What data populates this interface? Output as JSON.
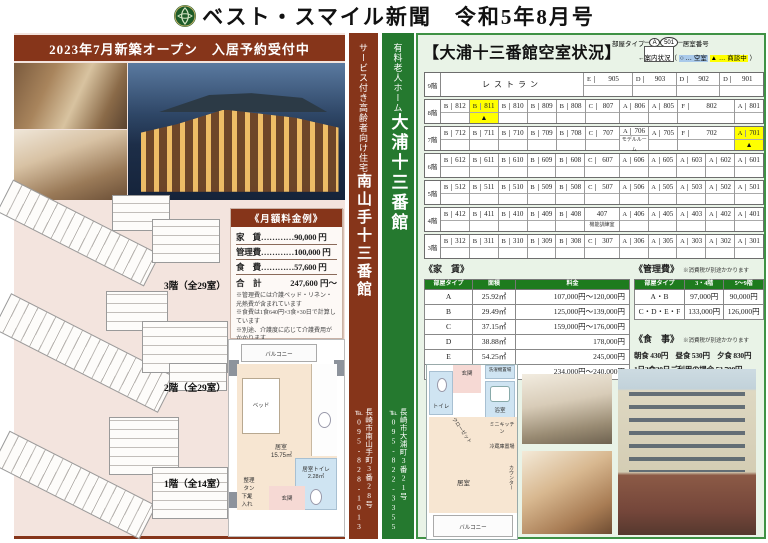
{
  "colors": {
    "maroon": "#86351a",
    "green": "#25792f",
    "table_green": "#1e7b1e",
    "highlight_yellow": "#ffff00",
    "highlight_blue": "#a9c9ea",
    "left_bg": "#f3e4de",
    "right_bg": "#e9f3e7"
  },
  "header": {
    "title": "ベスト・スマイル新聞　令和5年8月号",
    "logo": "camellia-emblem"
  },
  "left": {
    "banner": "2023年7月新築オープン　入居予約受付中",
    "floor_labels": [
      "3階（全29室）",
      "2階（全29室）",
      "1階（全14室）"
    ],
    "fee_box": {
      "title": "《月額料金例》",
      "lines": [
        "家　賃…………90,000 円",
        "管理費…………100,000 円",
        "食　費…………57,600 円"
      ],
      "total_label": "合　計",
      "total_value": "247,600 円～",
      "notes": [
        "※管理費には介護ベッド・リネン・光熱費が含まれています",
        "※食費は1食640円×3食×30日で計算しています",
        "※別途、介護度に応じて介護費用がかかります"
      ]
    },
    "room_plan": {
      "balcony": "バルコニー",
      "bed": "ベッド",
      "room": "居室",
      "room_size": "15.75㎡",
      "toilet": "居室トイレ",
      "toilet_size": "2.28㎡",
      "chest": "整理タンス",
      "shoe": "下足入れ",
      "entrance": "玄関"
    }
  },
  "strips": {
    "maroon": {
      "service": "サービス付き高齢者向け住宅",
      "name": "南山手十三番館",
      "address": "長崎市南山手町3番28号",
      "tel": "℡095-828-1013"
    },
    "green": {
      "service": "有料老人ホーム",
      "name": "大浦十三番館",
      "address": "長崎市大浦町3番21号",
      "tel": "℡095-822-3355"
    }
  },
  "right": {
    "title": "【大浦十三番館空室状況】",
    "legend": {
      "type_label": "部屋タイプ",
      "type_sample": "A",
      "no_sample": "501",
      "no_label": "居室番号",
      "status_prefix": "案内状況（",
      "vacant": "○ … 空室",
      "nego": "▲ … 商談中",
      "status_suffix": "）"
    },
    "grid": {
      "floors": [
        {
          "floor": "9階",
          "rooms": [
            {
              "label": "レストラン",
              "span": 5
            },
            {
              "type": "E",
              "no": "905",
              "span": 1.7
            },
            {
              "type": "D",
              "no": "903",
              "span": 1.5
            },
            {
              "type": "D",
              "no": "902",
              "span": 1.5
            },
            {
              "type": "D",
              "no": "901",
              "span": 1.5
            }
          ]
        },
        {
          "floor": "8階",
          "rooms": [
            {
              "type": "B",
              "no": "812"
            },
            {
              "type": "B",
              "no": "811",
              "status": "▲",
              "hl": true
            },
            {
              "type": "B",
              "no": "810"
            },
            {
              "type": "B",
              "no": "809"
            },
            {
              "type": "B",
              "no": "808"
            },
            {
              "type": "C",
              "no": "807",
              "span": 1.2
            },
            {
              "type": "A",
              "no": "806"
            },
            {
              "type": "A",
              "no": "805"
            },
            {
              "type": "F",
              "no": "802",
              "span": 2
            },
            {
              "type": "A",
              "no": "801"
            }
          ]
        },
        {
          "floor": "7階",
          "rooms": [
            {
              "type": "B",
              "no": "712"
            },
            {
              "type": "B",
              "no": "711"
            },
            {
              "type": "B",
              "no": "710"
            },
            {
              "type": "B",
              "no": "709"
            },
            {
              "type": "B",
              "no": "708"
            },
            {
              "type": "C",
              "no": "707",
              "span": 1.2
            },
            {
              "type": "A",
              "no": "706",
              "note": "モデルルーム"
            },
            {
              "type": "A",
              "no": "705"
            },
            {
              "type": "F",
              "no": "702",
              "span": 2
            },
            {
              "type": "A",
              "no": "701",
              "status": "▲",
              "hl": true
            }
          ]
        },
        {
          "floor": "6階",
          "rooms": [
            {
              "type": "B",
              "no": "612"
            },
            {
              "type": "B",
              "no": "611"
            },
            {
              "type": "B",
              "no": "610"
            },
            {
              "type": "B",
              "no": "609"
            },
            {
              "type": "B",
              "no": "608"
            },
            {
              "type": "C",
              "no": "607",
              "span": 1.2
            },
            {
              "type": "A",
              "no": "606"
            },
            {
              "type": "A",
              "no": "605"
            },
            {
              "type": "A",
              "no": "603"
            },
            {
              "type": "A",
              "no": "602"
            },
            {
              "type": "A",
              "no": "601"
            }
          ]
        },
        {
          "floor": "5階",
          "rooms": [
            {
              "type": "B",
              "no": "512"
            },
            {
              "type": "B",
              "no": "511"
            },
            {
              "type": "B",
              "no": "510"
            },
            {
              "type": "B",
              "no": "509"
            },
            {
              "type": "B",
              "no": "508"
            },
            {
              "type": "C",
              "no": "507",
              "span": 1.2
            },
            {
              "type": "A",
              "no": "506"
            },
            {
              "type": "A",
              "no": "505"
            },
            {
              "type": "A",
              "no": "503"
            },
            {
              "type": "A",
              "no": "502"
            },
            {
              "type": "A",
              "no": "501"
            }
          ]
        },
        {
          "floor": "4階",
          "rooms": [
            {
              "type": "B",
              "no": "412"
            },
            {
              "type": "B",
              "no": "411"
            },
            {
              "type": "B",
              "no": "410"
            },
            {
              "type": "B",
              "no": "409"
            },
            {
              "type": "B",
              "no": "408"
            },
            {
              "type": "",
              "no": "407",
              "span": 1.2,
              "note": "機能訓練室"
            },
            {
              "type": "A",
              "no": "406"
            },
            {
              "type": "A",
              "no": "405"
            },
            {
              "type": "A",
              "no": "403"
            },
            {
              "type": "A",
              "no": "402"
            },
            {
              "type": "A",
              "no": "401"
            }
          ]
        },
        {
          "floor": "3階",
          "rooms": [
            {
              "type": "B",
              "no": "312"
            },
            {
              "type": "B",
              "no": "311"
            },
            {
              "type": "B",
              "no": "310"
            },
            {
              "type": "B",
              "no": "309"
            },
            {
              "type": "B",
              "no": "308"
            },
            {
              "type": "C",
              "no": "307",
              "span": 1.2
            },
            {
              "type": "A",
              "no": "306"
            },
            {
              "type": "A",
              "no": "305"
            },
            {
              "type": "A",
              "no": "303"
            },
            {
              "type": "A",
              "no": "302"
            },
            {
              "type": "A",
              "no": "301"
            }
          ]
        }
      ]
    },
    "rent_table": {
      "title": "《家　賃》",
      "headers": [
        "部屋タイプ",
        "面積",
        "料金"
      ],
      "rows": [
        [
          "A",
          "25.92㎡",
          "107,000円～120,000円"
        ],
        [
          "B",
          "29.49㎡",
          "125,000円～139,000円"
        ],
        [
          "C",
          "37.15㎡",
          "159,000円～176,000円"
        ],
        [
          "D",
          "38.88㎡",
          "178,000円"
        ],
        [
          "E",
          "54.25㎡",
          "245,000円"
        ],
        [
          "F",
          "51.84㎡",
          "234,000円～240,000円"
        ]
      ]
    },
    "mgmt_table": {
      "title": "《管理費》",
      "note": "※消費税が別途かかります",
      "headers": [
        "部屋タイプ",
        "3・4階",
        "5～9階"
      ],
      "rows": [
        [
          "A・B",
          "97,000円",
          "90,000円"
        ],
        [
          "C・D・E・F",
          "133,000円",
          "126,000円"
        ]
      ]
    },
    "meals": {
      "title": "《食　事》",
      "note": "※消費税が別途かかります",
      "line1": "朝食 430円　昼食 530円　夕食 830円",
      "line2": "1日3食30日ご利用の場合 53,700円"
    },
    "room_plan2": {
      "entrance": "玄関",
      "laundry": "洗濯機置場",
      "toilet": "トイレ",
      "bath": "浴室",
      "closet": "クローゼット",
      "kitchen": "ミニキッチン",
      "fridge": "冷蔵庫置場",
      "counter": "カウンター",
      "room": "居室",
      "balcony": "バルコニー"
    }
  }
}
